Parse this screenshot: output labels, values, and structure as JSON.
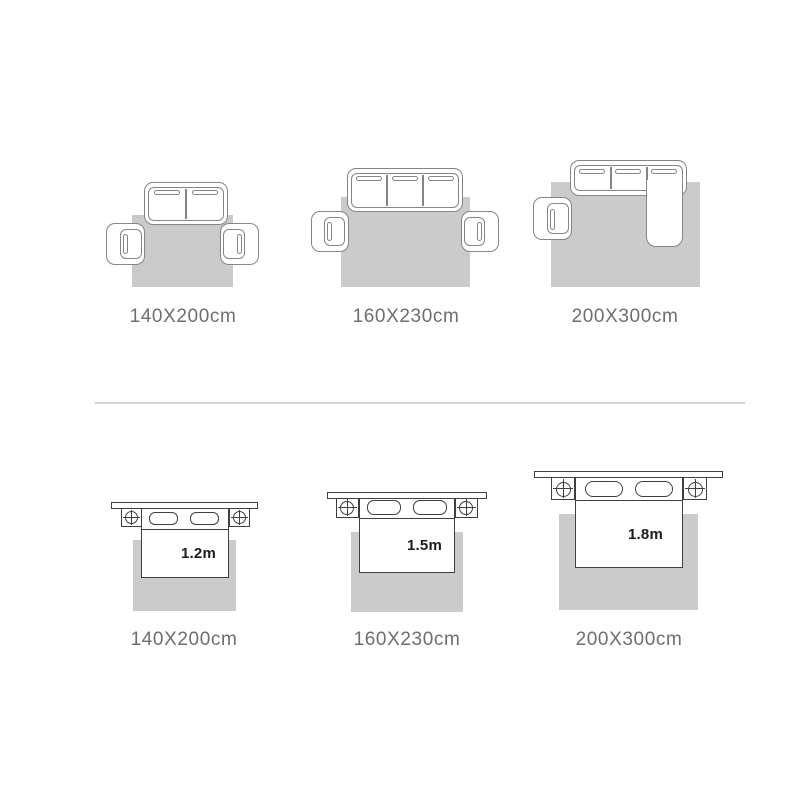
{
  "image_type": "rug-size-guide-diagram",
  "colors": {
    "background": "#ffffff",
    "rug_fill": "#cbcbcb",
    "furniture_fill": "#ffffff",
    "sofa_outline": "#858585",
    "bed_outline": "#3f3f3f",
    "caption_text": "#6e6e6e",
    "bed_label_text": "#1c1c1c",
    "divider_line": "#d4d4d4"
  },
  "sofa_section": {
    "icons": [
      "sofa-2-seat-icon",
      "sofa-3-seat-icon",
      "sectional-sofa-icon",
      "armchair-icon",
      "rug-icon"
    ],
    "panels": [
      {
        "caption": "140X200cm"
      },
      {
        "caption": "160X230cm"
      },
      {
        "caption": "200X300cm"
      }
    ]
  },
  "bed_section": {
    "icons": [
      "headboard-icon",
      "nightstand-icon",
      "pillow-icon",
      "bed-icon",
      "rug-icon"
    ],
    "panels": [
      {
        "bed_width": "1.2m",
        "caption": "140X200cm"
      },
      {
        "bed_width": "1.5m",
        "caption": "160X230cm"
      },
      {
        "bed_width": "1.8m",
        "caption": "200X300cm"
      }
    ]
  }
}
